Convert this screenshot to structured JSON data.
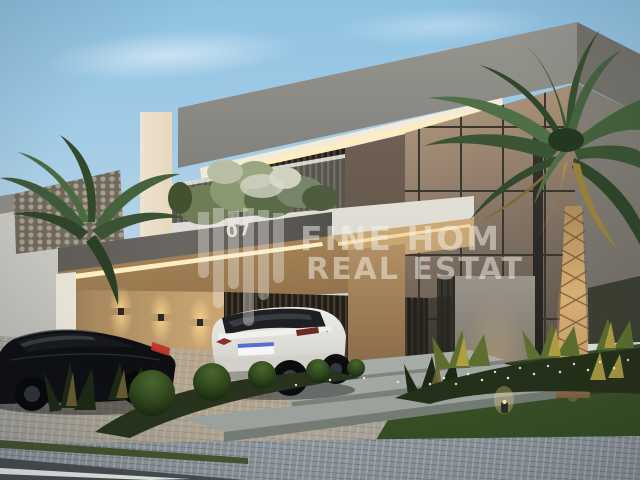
{
  "scene": {
    "watermark": {
      "line1": "FINE HOM",
      "line2": "REAL ESTAT"
    },
    "house": {
      "number": "07"
    },
    "palette": {
      "sky_top": "#8fc2e2",
      "sky_horizon": "#e7e4da",
      "roof_gray": "#8a8983",
      "facade_white": "#eceae3",
      "slat_dark": "#3a3127",
      "warm_led": "#ffedc2",
      "beige_wall": "#c7a472",
      "lawn_green": "#4c6835",
      "palm_green": "#44613c",
      "palm_trunk": "#c9a268",
      "driveway_gray": "#a3a4a1",
      "taillight_red": "#c0322a"
    }
  }
}
